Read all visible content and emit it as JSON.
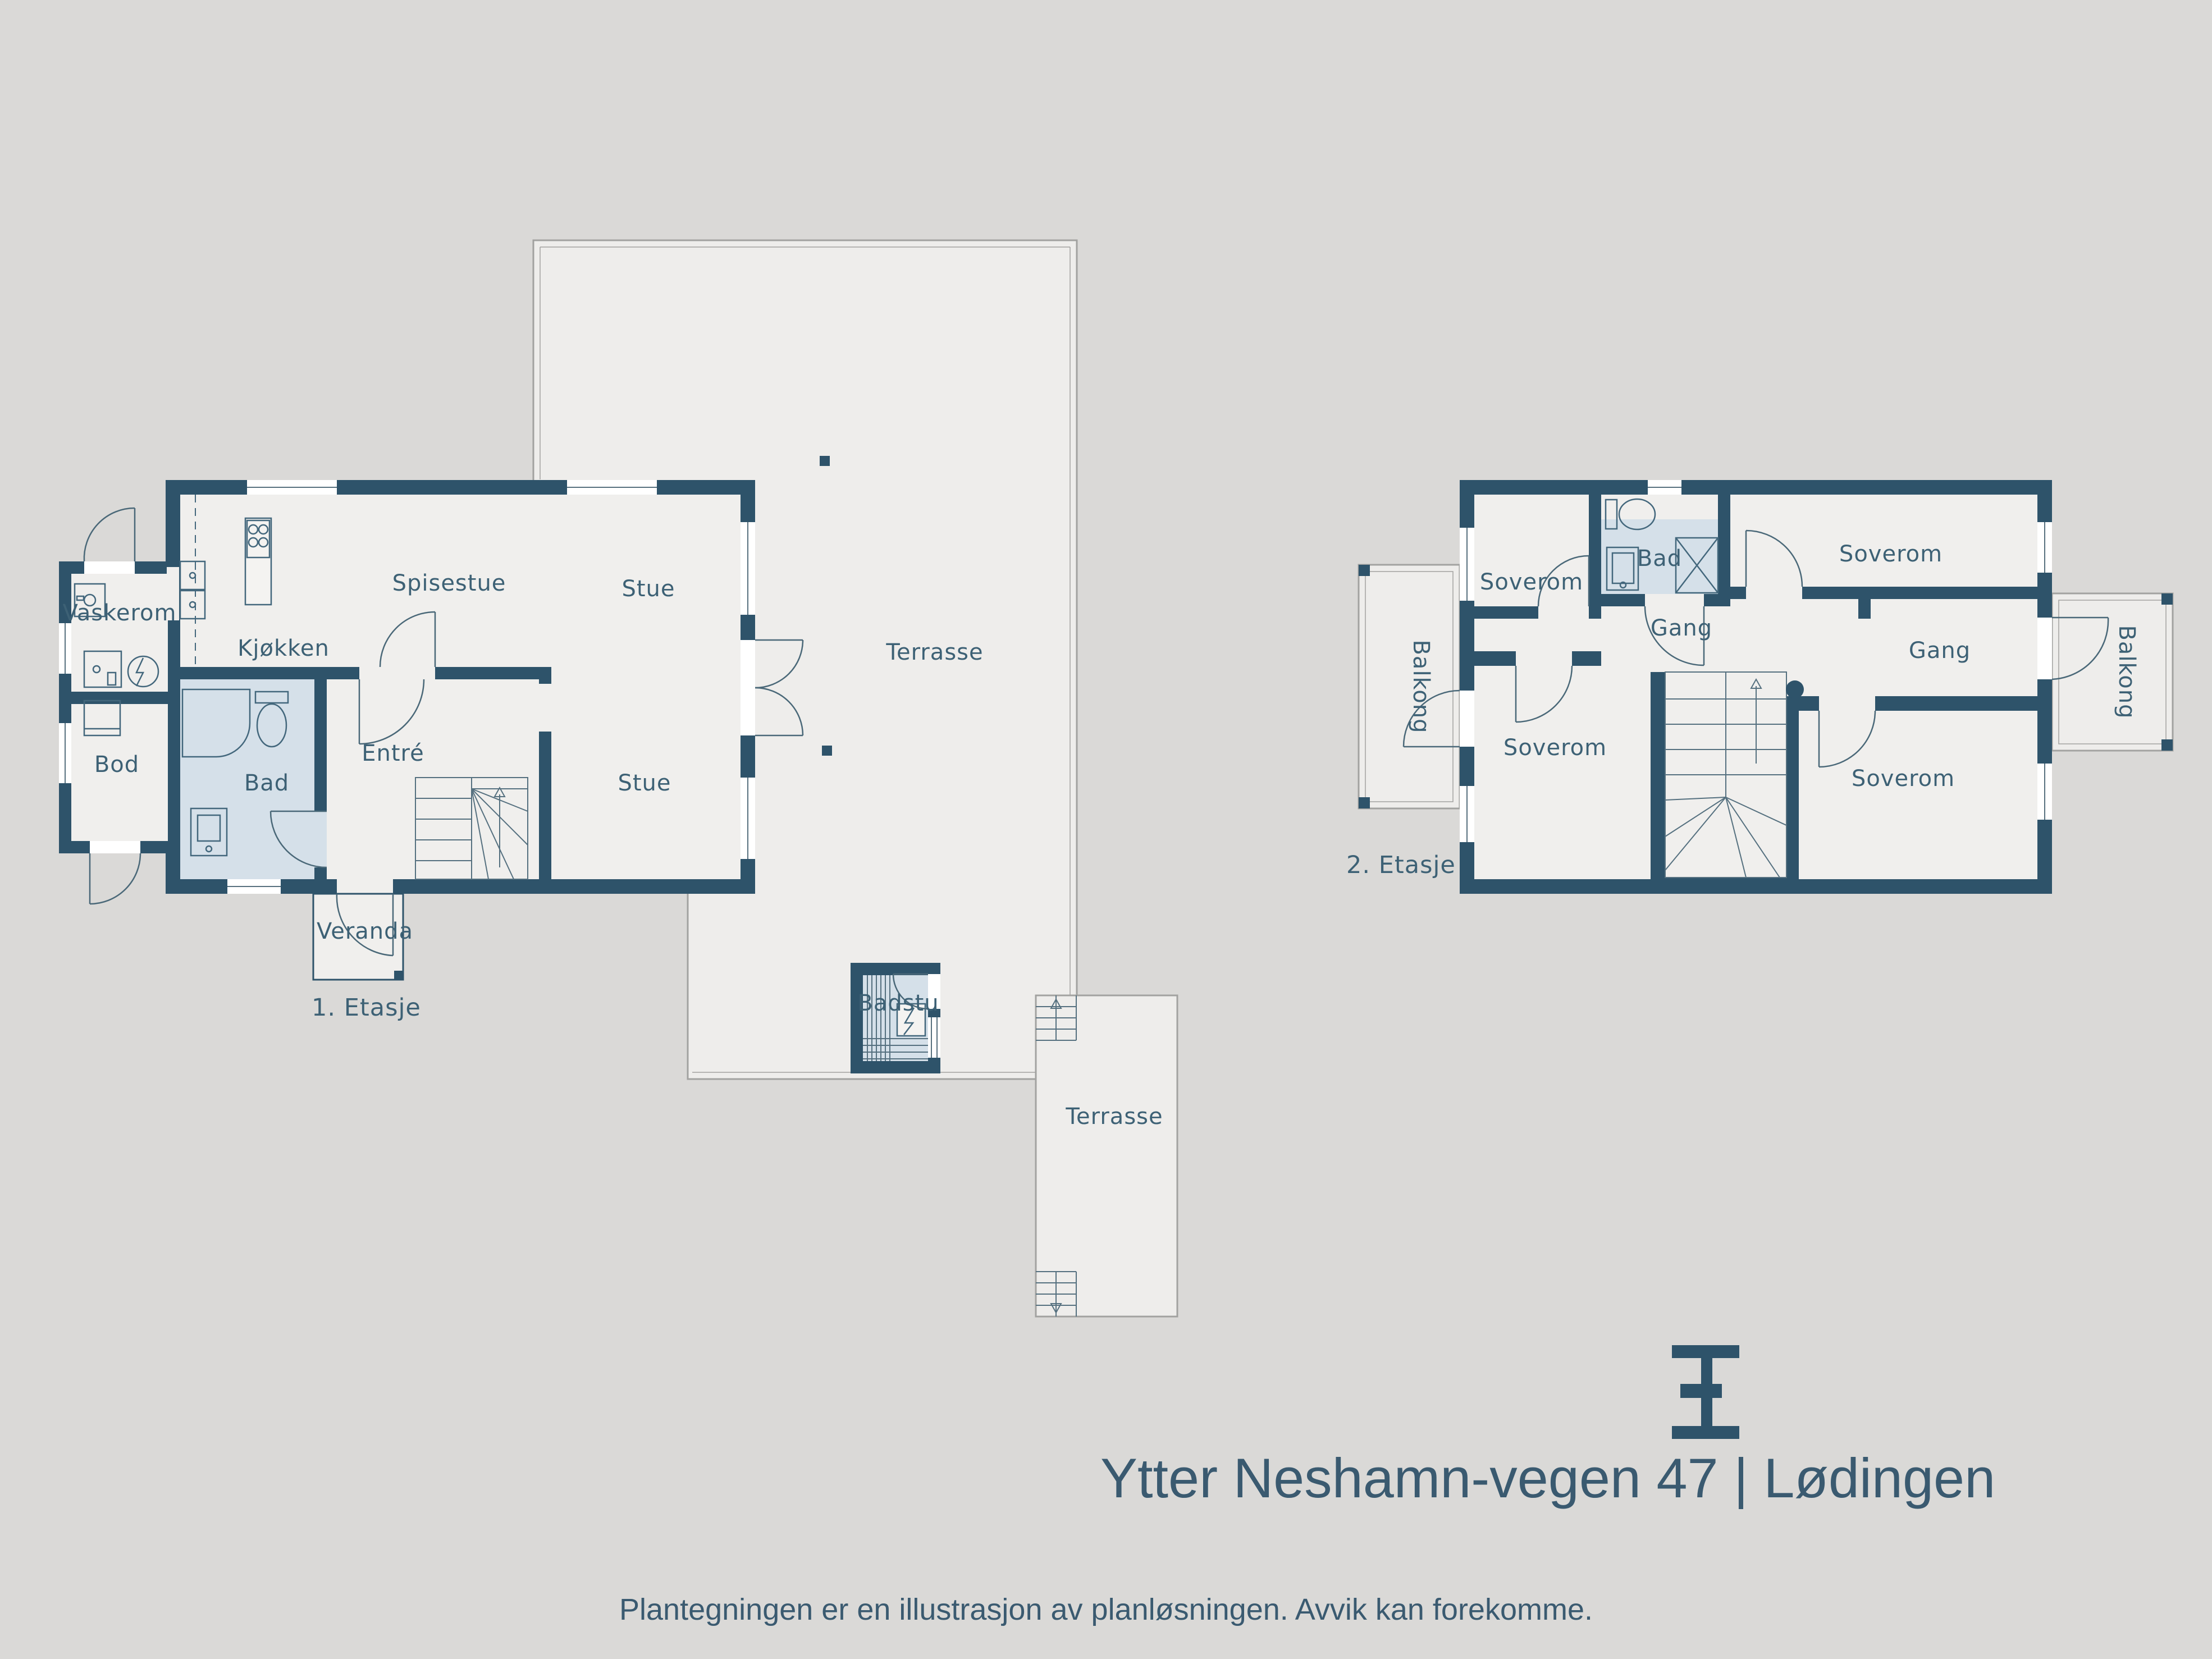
{
  "document": {
    "type": "floor-plan-sheet",
    "title": "Ytter Neshamn-vegen 47 | Lødingen",
    "disclaimer": "Plantegningen er en illustrasjon av planløsningen. Avvik kan forekomme."
  },
  "floor1": {
    "tag": "1. Etasje",
    "labels": {
      "vaskerom": "Vaskerom",
      "bod": "Bod",
      "kjokken": "Kjøkken",
      "spisestue": "Spisestue",
      "stue_upper": "Stue",
      "stue_lower": "Stue",
      "bad": "Bad",
      "entre": "Entré",
      "veranda": "Veranda",
      "terrasse_main": "Terrasse",
      "badstu": "Badstu",
      "terrasse_lower": "Terrasse"
    }
  },
  "floor2": {
    "tag": "2. Etasje",
    "labels": {
      "soverom_tl": "Soverom",
      "bad": "Bad",
      "soverom_tr": "Soverom",
      "gang_center": "Gang",
      "gang_right": "Gang",
      "soverom_bl": "Soverom",
      "soverom_br": "Soverom",
      "balkong_left": "Balkong",
      "balkong_right": "Balkong"
    }
  },
  "colors": {
    "background": "#dad9d7",
    "wall": "#2e536a",
    "room_fill": "#f0efed",
    "wet_room_fill": "#d5e0e9",
    "terrace_fill": "#eeedeb",
    "label_text": "#3d6175",
    "title_text": "#3a5a70"
  }
}
